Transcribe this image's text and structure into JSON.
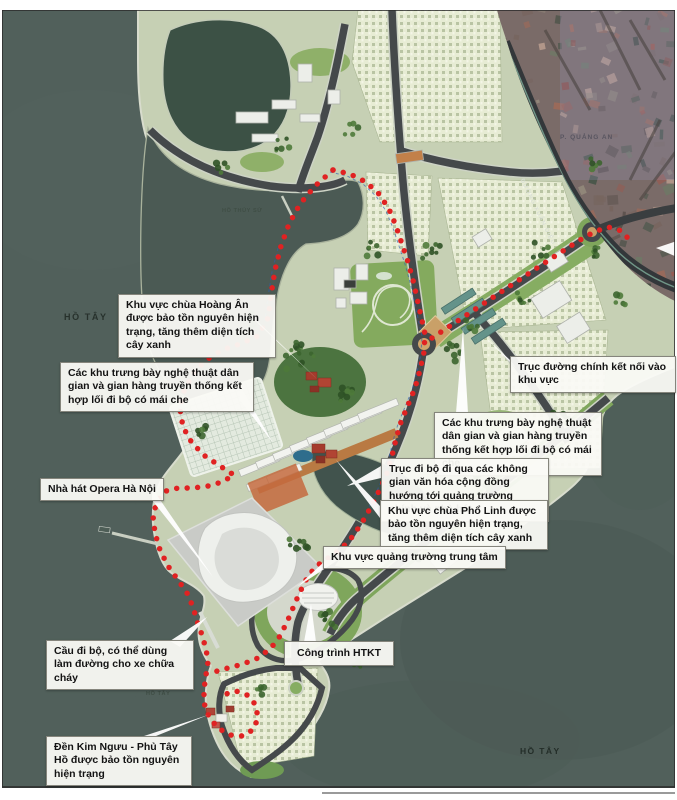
{
  "map": {
    "title": "Quy hoạch bán đảo Quảng An - Hồ Tây",
    "colors": {
      "water": "#51605b",
      "land": "#c6d0b4",
      "village": "#e7ecd4",
      "park": "#7fa65c",
      "road": "#45494b",
      "boundary": "#e02222",
      "satellite_base": "#7a6b68",
      "callout_bg": "#fafaf6"
    },
    "water_labels": {
      "ho_tay_main": "HỒ TÂY",
      "ho_thuy_su": "HỒ THỦY SỨ",
      "ho_tay_left_small": "HỒ TÂY",
      "ho_tay_bottom": "HỒ TÂY",
      "ward": "P. QUẢNG AN",
      "road_xuan_dieu": "ĐƯỜNG XUÂN DIỆU"
    },
    "callouts": [
      {
        "id": "chua-hoang-an",
        "text": "Khu vực chùa Hoàng Ân được bảo tồn nguyên hiện trạng, tăng thêm diện tích cây xanh"
      },
      {
        "id": "trung-bay-left",
        "text": "Các khu trưng bày nghệ thuật dân gian và gian hàng truyền thống kết hợp lối đi bộ có mái che"
      },
      {
        "id": "truc-duong-chinh",
        "text": "Trục đường chính kết nối vào khu vực"
      },
      {
        "id": "trung-bay-right",
        "text": "Các khu trưng bày nghệ thuật dân gian và gian hàng truyền thống kết hợp lối đi bộ có mái che"
      },
      {
        "id": "truc-di-bo",
        "text": "Trục đi bộ đi qua các không gian văn hóa cộng đồng hướng tới quảng trường chính và nhà hát"
      },
      {
        "id": "chua-pho-linh",
        "text": "Khu vực chùa Phổ Linh được bảo tồn nguyên hiện trạng, tăng thêm diện tích cây xanh"
      },
      {
        "id": "quang-truong",
        "text": "Khu vực quảng trường trung tâm"
      },
      {
        "id": "opera",
        "text": "Nhà hát Opera Hà Nội"
      },
      {
        "id": "cau-di-bo",
        "text": "Cầu đi bộ, có thể dùng làm đường cho xe chữa cháy"
      },
      {
        "id": "htkt",
        "text": "Công trình HTKT"
      },
      {
        "id": "den-kim-nguu",
        "text": "Đền Kim Ngưu - Phủ Tây Hồ được bảo tồn nguyên hiện trạng"
      }
    ]
  }
}
